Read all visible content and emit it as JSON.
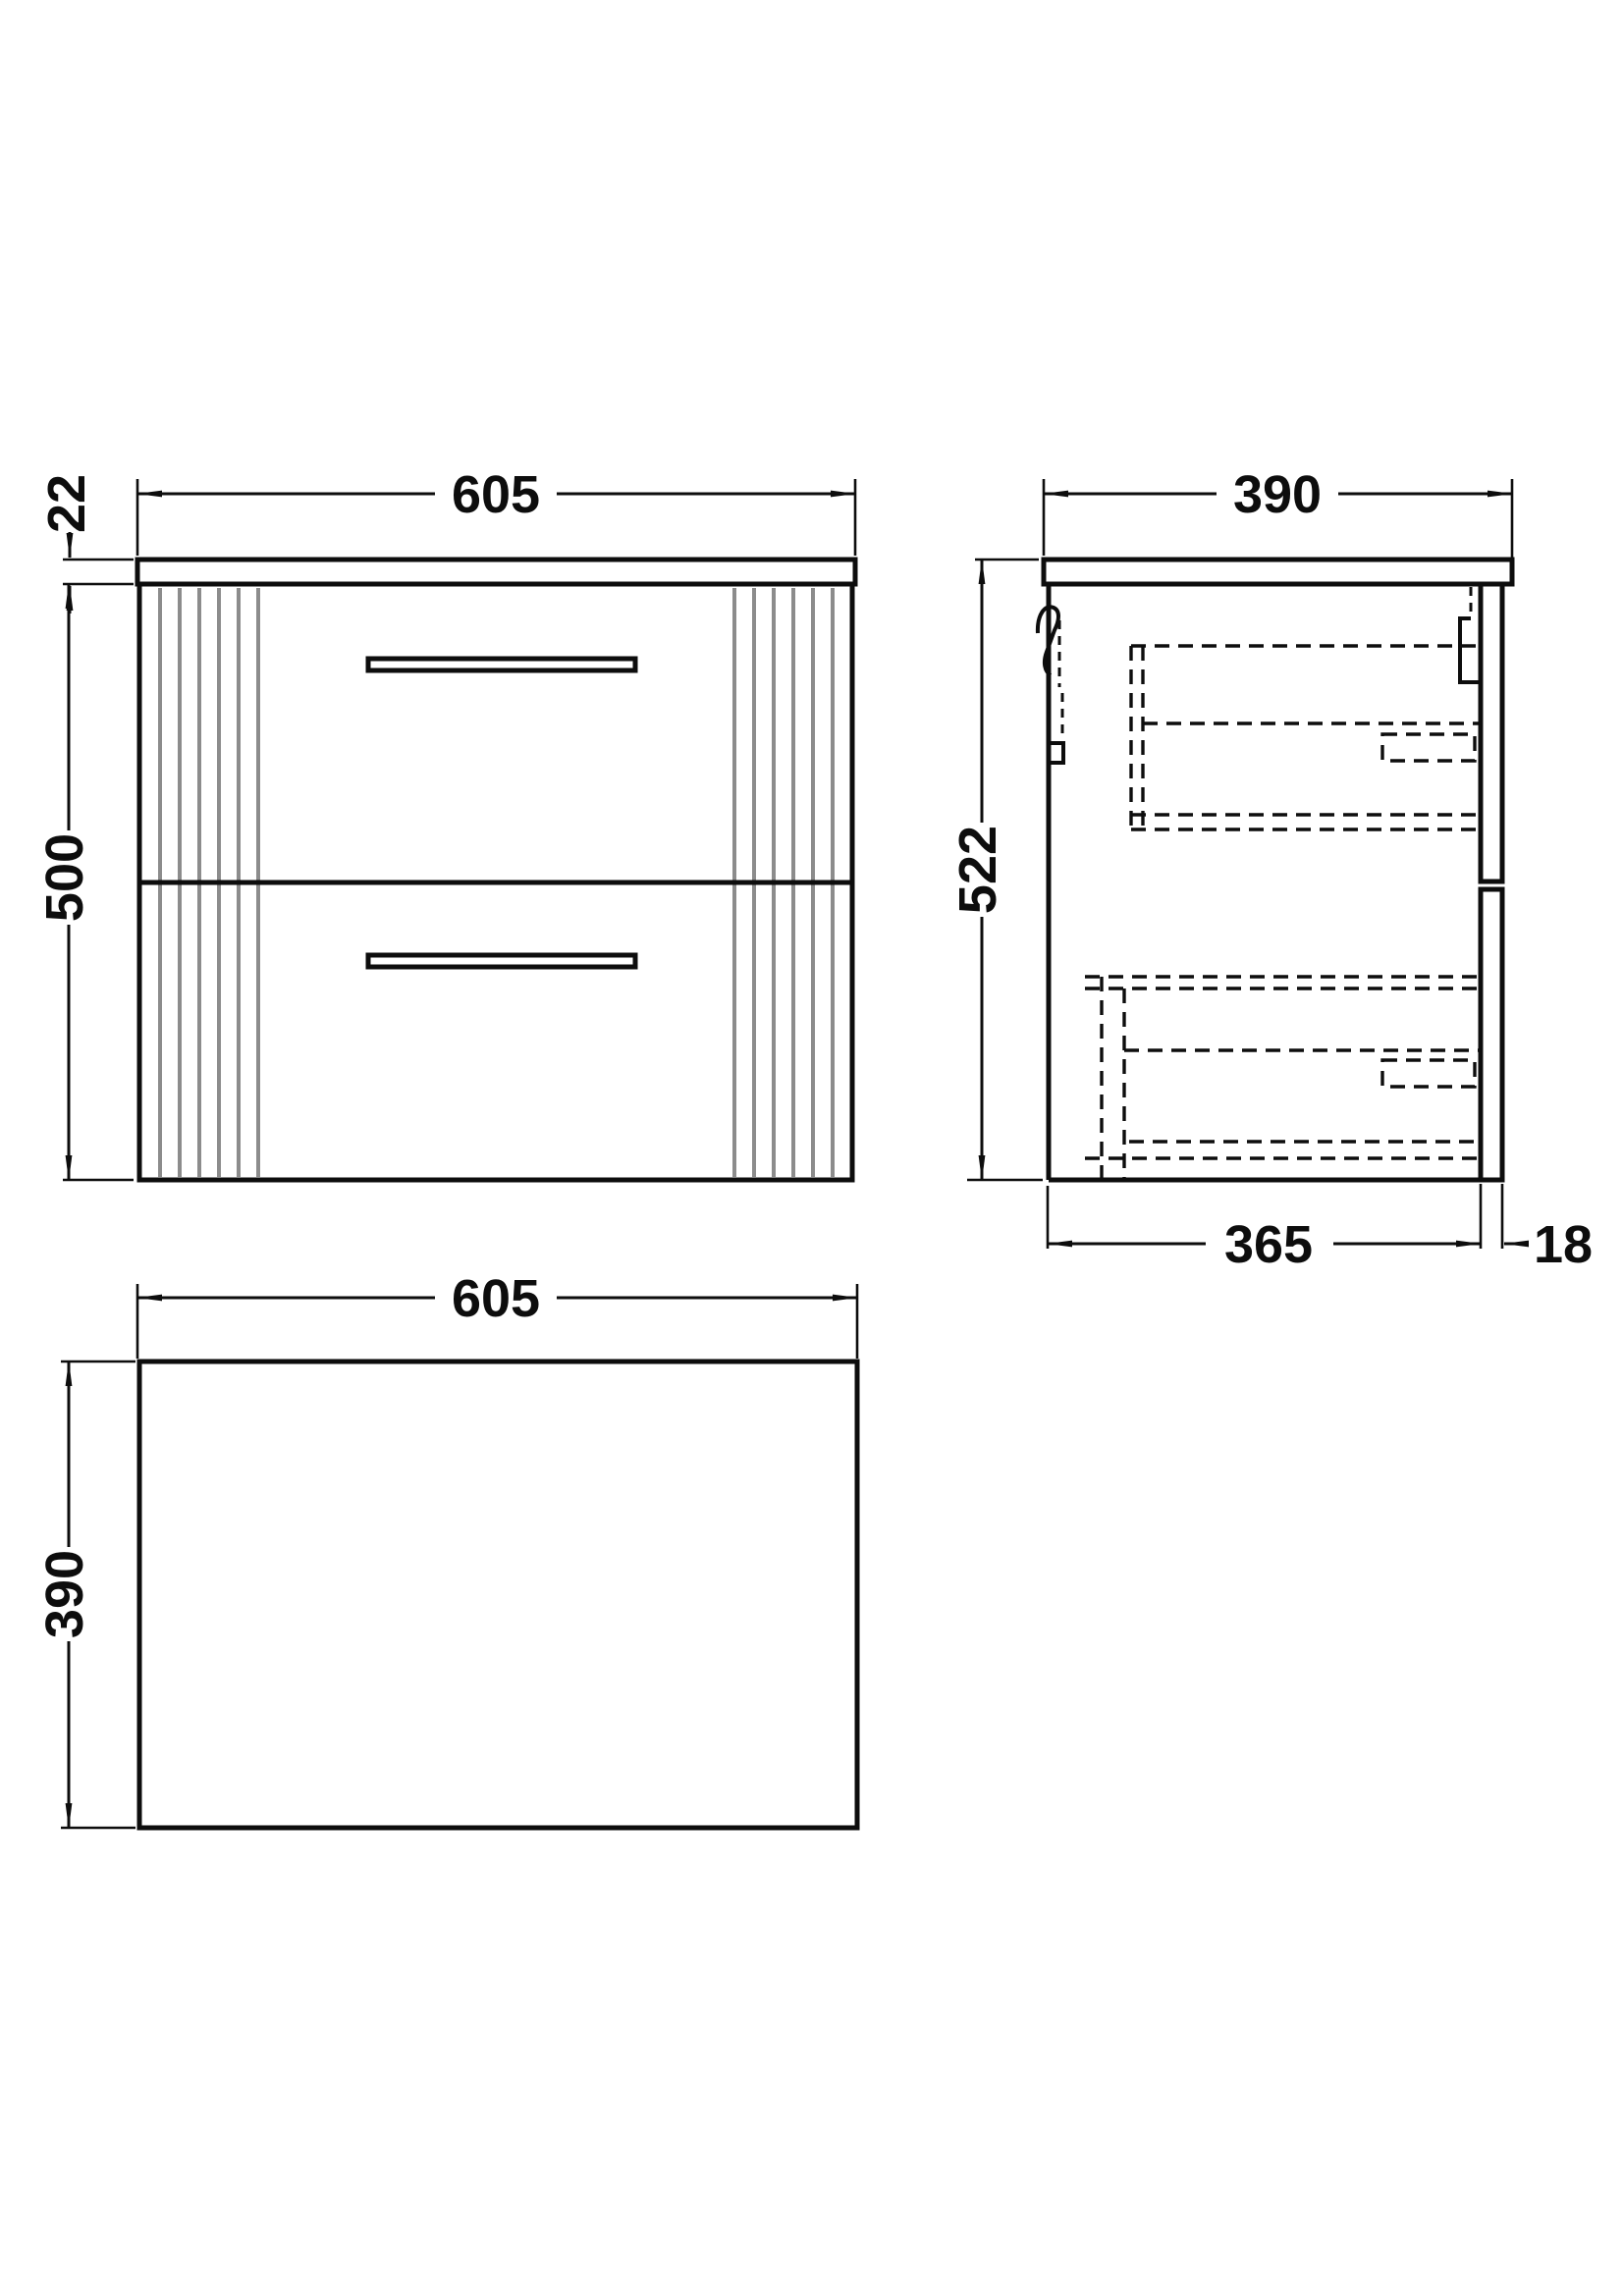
{
  "drawing": {
    "type": "furniture-technical-drawing",
    "views": {
      "front": {
        "name": "front-elevation"
      },
      "side": {
        "name": "side-section"
      },
      "plan": {
        "name": "plan-view"
      }
    }
  },
  "dims": {
    "front": {
      "width": "605",
      "worktop_thickness": "22",
      "height": "500"
    },
    "side": {
      "depth": "390",
      "height": "522",
      "body_depth": "365",
      "front_thickness": "18"
    },
    "plan": {
      "width": "605",
      "depth": "390"
    }
  },
  "colors": {
    "line": "#0d0d0d",
    "flute": "#8c8c8c",
    "background": "#ffffff"
  }
}
